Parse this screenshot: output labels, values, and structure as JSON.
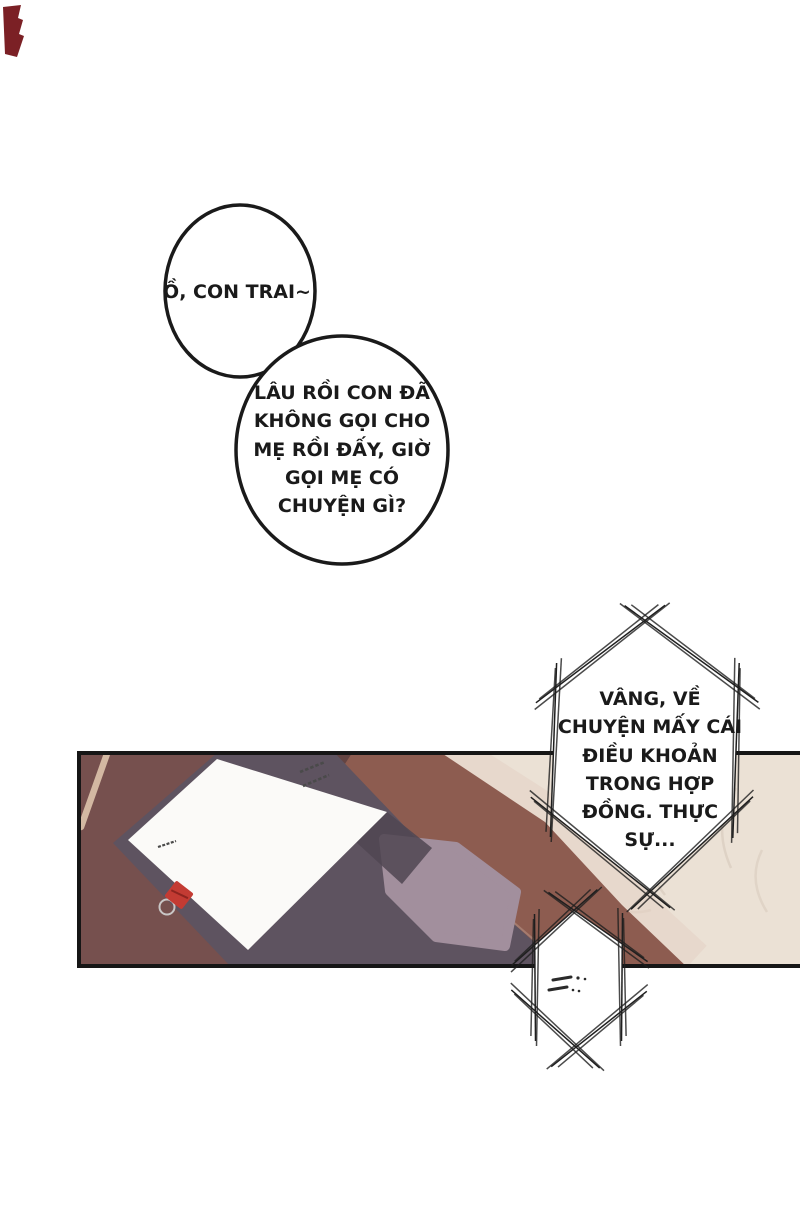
{
  "comic": {
    "kind": "manhwa page (Vietnamese translation)",
    "panel_count": 1
  },
  "speech": {
    "bubble_small": "Ồ, CON TRAI~",
    "bubble_large": [
      "LÂU RỒI CON ĐÃ",
      "KHÔNG GỌI CHO",
      "MẸ RỒI ĐẤY, GIỜ",
      "GỌI MẸ CÓ",
      "CHUYỆN GÌ?"
    ],
    "hex_large": [
      "VÂNG, VỀ",
      "CHUYỆN MẤY CÁI",
      "ĐIỀU KHOẢN",
      "TRONG HỢP",
      "ĐỒNG. THỰC",
      "SỰ..."
    ],
    "hex_small_scribble": "..."
  },
  "colors": {
    "outline": "#1a1a1a",
    "desk": "#76504e",
    "desk_edge": "#8d5c50",
    "desk_mat": "#5e5360",
    "notebook": "#a28f9d",
    "paper": "#fbfaf8",
    "floor_marble": "#ebe1d5",
    "clip_red": "#c33b33",
    "corner_mark_red": "#7b2025"
  }
}
